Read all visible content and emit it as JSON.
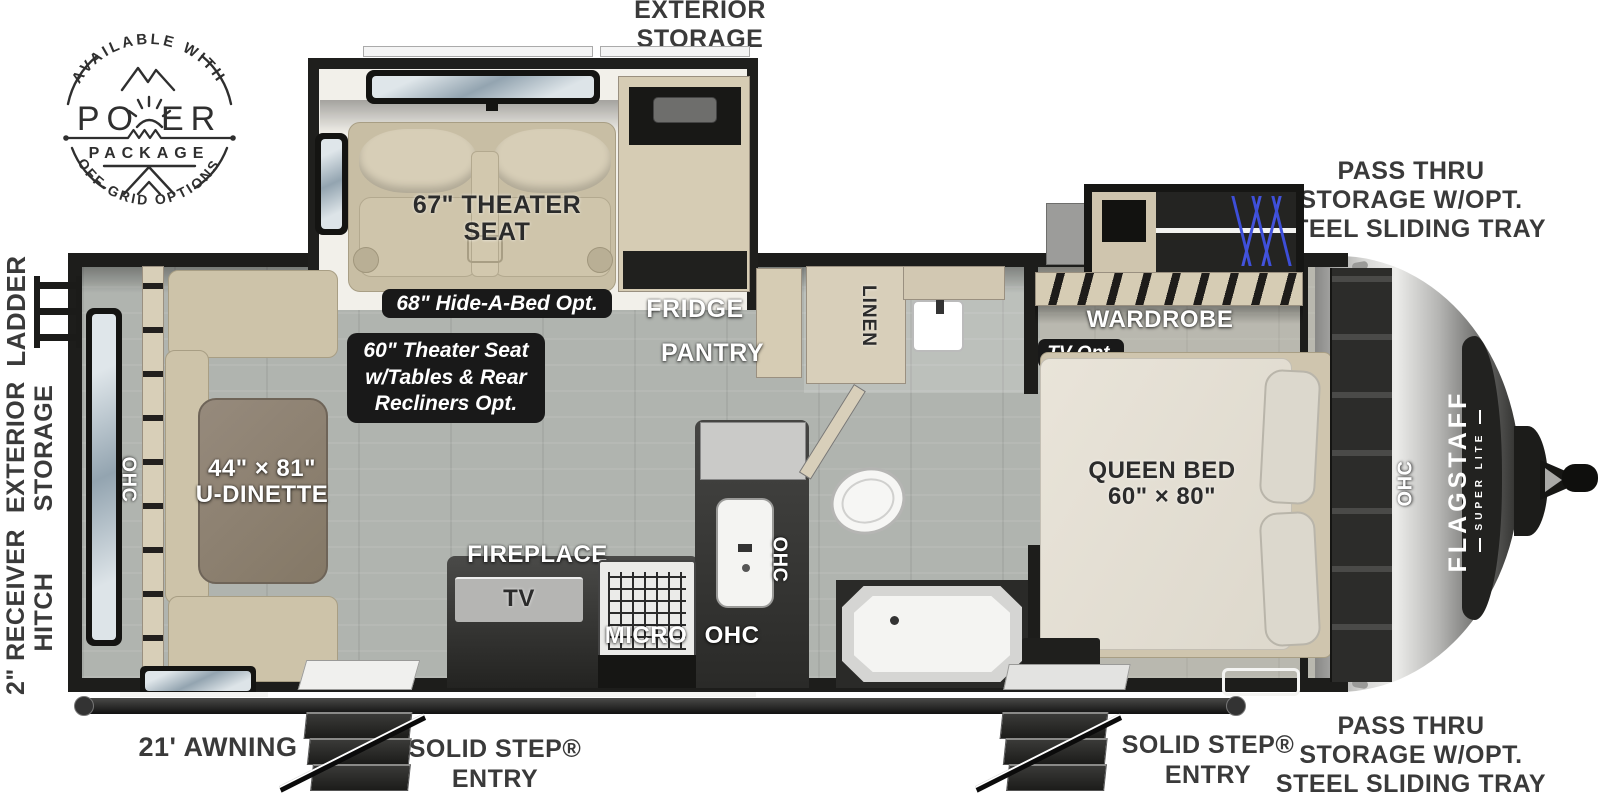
{
  "badge": {
    "top_arc": "AVAILABLE WITH",
    "power_left": "PO",
    "power_right": "ER",
    "package": "PACKAGE",
    "bottom_arc": "OFF-GRID OPTIONS"
  },
  "callouts": {
    "exterior_storage": [
      "EXTERIOR",
      "STORAGE"
    ],
    "pass_thru_top": [
      "PASS THRU",
      "STORAGE W/OPT.",
      "STEEL SLIDING TRAY"
    ],
    "pass_thru_bottom": [
      "PASS THRU",
      "STORAGE W/OPT.",
      "STEEL SLIDING TRAY"
    ],
    "ladder": "LADDER",
    "exterior_storage_side": [
      "EXTERIOR",
      "STORAGE"
    ],
    "receiver_hitch": [
      "2\" RECEIVER",
      "HITCH"
    ],
    "awning": "21' AWNING",
    "entry_left": [
      "SOLID STEP®",
      "ENTRY"
    ],
    "entry_right": [
      "SOLID STEP®",
      "ENTRY"
    ]
  },
  "rooms": {
    "theater_seat": [
      "67\" THEATER",
      "SEAT"
    ],
    "hide_a_bed": "68\" Hide-A-Bed Opt.",
    "theater_opt": [
      "60\" Theater Seat",
      "w/Tables & Rear",
      "Recliners Opt."
    ],
    "fridge": "FRIDGE",
    "pantry": "PANTRY",
    "linen": "LINEN",
    "fireplace": "FIREPLACE",
    "tv": "TV",
    "micro": "MICRO",
    "ohc": "OHC",
    "dinette": [
      "44\" × 81\"",
      "U-DINETTE"
    ],
    "wardrobe": "WARDROBE",
    "tv_opt": "TV Opt.",
    "queen_bed": [
      "QUEEN BED",
      "60\" × 80\""
    ]
  },
  "brand": {
    "model": "FLAGSTAFF",
    "trim": "SUPER LITE"
  },
  "colors": {
    "wall": "#1d1d1b",
    "floor": "#b0b4af",
    "cabinet": "#d6ccb4",
    "sofa": "#cdc3a9",
    "table": "#8d8174",
    "pill_bg": "#191919",
    "hanger_blue": "#3d4ed8",
    "nose_silver": "#d9d9d7",
    "label_white": "#ffffff",
    "label_dark": "#2b2b2b"
  }
}
